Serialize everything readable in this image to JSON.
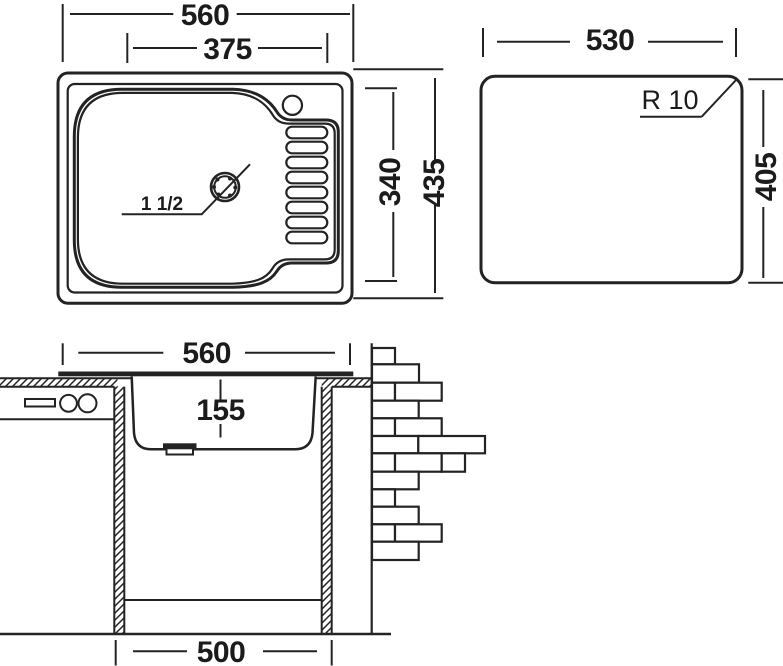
{
  "drawing": {
    "type": "kitchen sink technical dimension drawing",
    "units_note": "mm",
    "top_view": {
      "overall_width": "560",
      "bowl_width": "375",
      "bowl_depth": "340",
      "overall_depth": "435",
      "drain_size": "1 1/2"
    },
    "cutout_view": {
      "width": "530",
      "corner_radius": "R 10",
      "height": "405"
    },
    "section_view": {
      "overall_width": "560",
      "bowl_depth": "155",
      "cabinet_width": "500"
    }
  },
  "colors": {
    "line": "#232323",
    "text": "#1b1b1b",
    "background": "#ffffff"
  }
}
